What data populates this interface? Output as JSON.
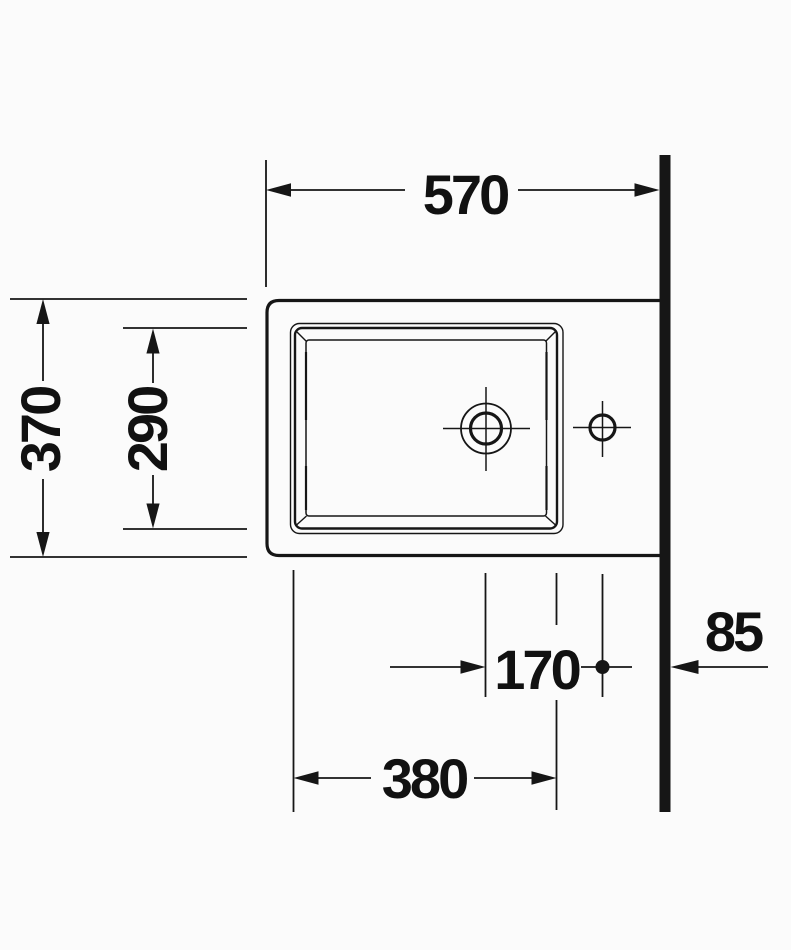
{
  "colors": {
    "background": "#fbfbfb",
    "line": "#161616",
    "text": "#111111"
  },
  "labels": {
    "dim_overall_width": "570",
    "dim_overall_depth": "370",
    "dim_basin_depth": "290",
    "dim_drain_to_tap": "170",
    "dim_basin_width": "380",
    "dim_tap_to_wall": "85"
  }
}
